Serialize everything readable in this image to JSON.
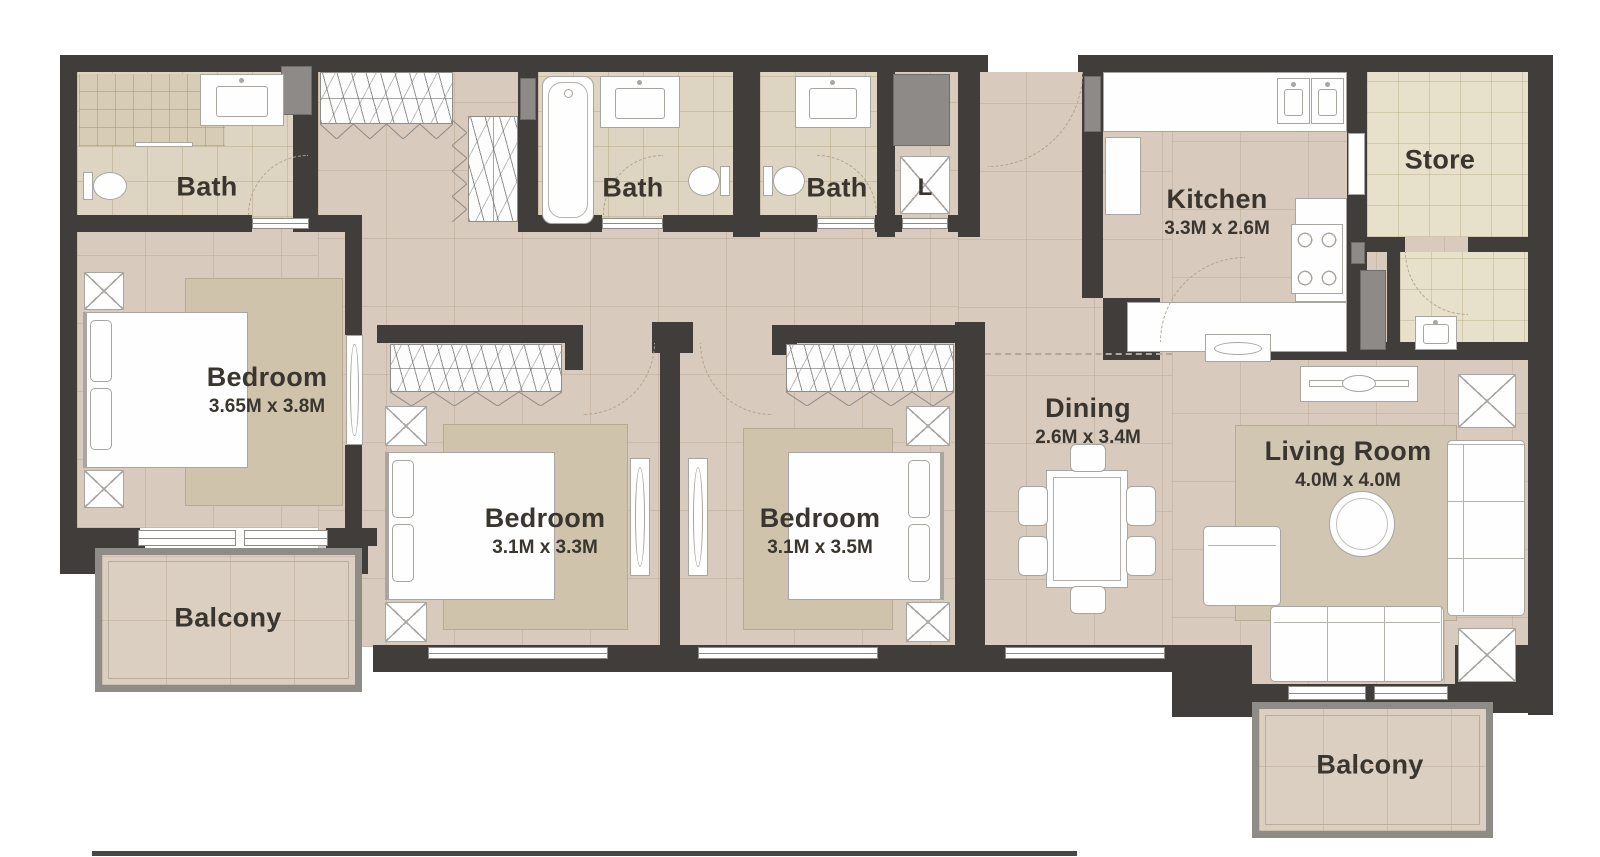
{
  "plan_title": "3-bedroom apartment floor plan",
  "colors": {
    "wall": "#413d3b",
    "floor": "#d8cabd",
    "bath_floor": "#ddd4c1",
    "store_floor": "#e7e0cb",
    "rug": "#cfc3ab",
    "balcony_frame": "#8f8b86",
    "shaft_gray": "#8d8a87",
    "furniture_outline": "#a9a5a0",
    "label_text": "#3a362f"
  },
  "rooms": {
    "bath_top_left": {
      "label": "Bath"
    },
    "bath_mid_left": {
      "label": "Bath"
    },
    "bath_mid_right": {
      "label": "Bath"
    },
    "laundry": {
      "label": "L"
    },
    "kitchen": {
      "label": "Kitchen",
      "dims": "3.3M x 2.6M"
    },
    "store": {
      "label": "Store"
    },
    "bedroom_left": {
      "label": "Bedroom",
      "dims": "3.65M x 3.8M"
    },
    "bedroom_mid": {
      "label": "Bedroom",
      "dims": "3.1M x 3.3M"
    },
    "bedroom_right": {
      "label": "Bedroom",
      "dims": "3.1M x 3.5M"
    },
    "dining": {
      "label": "Dining",
      "dims": "2.6M x 3.4M"
    },
    "living_room": {
      "label": "Living Room",
      "dims": "4.0M x 4.0M"
    },
    "balcony_left": {
      "label": "Balcony"
    },
    "balcony_right": {
      "label": "Balcony"
    }
  }
}
